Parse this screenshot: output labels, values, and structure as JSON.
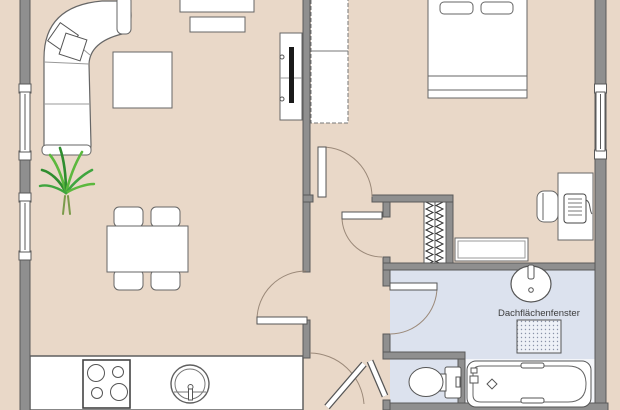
{
  "plan": {
    "type": "floorplan",
    "bathroom": {
      "roof_window_label": "Dachflächenfenster"
    }
  },
  "colors": {
    "floor": "#e9d8c8",
    "bathroom_floor": "#dce2ee",
    "tub_area_floor": "#f4f6fa",
    "wall": "#8f8f8f",
    "wall_outline": "#5a5a5a",
    "furniture_fill": "#ffffff",
    "furniture_outline": "#666666",
    "door_arc": "#9b8979",
    "tv_screen": "#1a1a1a",
    "plant_green_dark": "#2f8d2f",
    "plant_green_light": "#5cb83e"
  }
}
